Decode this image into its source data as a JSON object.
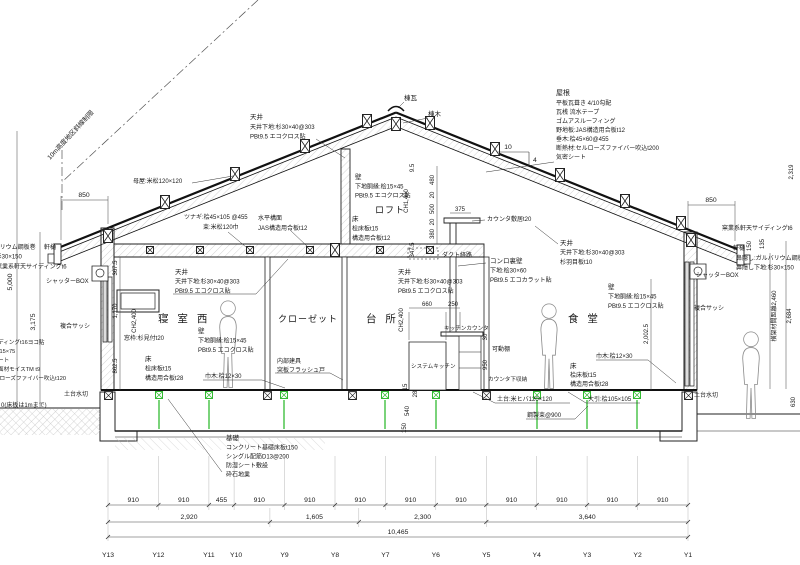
{
  "drawing_title_note": "木造住宅 矩計図(断面詳細図)",
  "labels": {
    "height_limit": "10m高度地区斜線制限",
    "purlin": "母屋:米松120×120",
    "ridge_tile": "棟瓦",
    "ridge_beam": "棟木",
    "slope_run": "10",
    "slope_rise": "4",
    "tie": "ツナギ:桧45×105 @455",
    "loft_post": "束:米松120巾",
    "counter_sill": "カウンタ敷居t20",
    "duct": "ダクト経路",
    "loft": "ロフト",
    "room_bedroom": "寝 室 西",
    "room_closet": "クローゼット",
    "room_kitchen": "台 所",
    "room_dining": "食 堂",
    "window_frame": "窓枠:杉見付t20",
    "baseboard_left": "巾木:桧12×30",
    "baseboard_right": "巾木:桧12×30",
    "kitchen_counter": "キッチンカウンタ",
    "shelves": "可動棚",
    "system_kitchen": "システムキッチン",
    "counter_storage": "カウンタ下収納",
    "soffit_left": "窯業系軒天サイディングt6",
    "soffit_right": "窯業系軒天サイディングt6",
    "gutter_left": "軒樋",
    "gutter_right": "軒樋",
    "fascia_left": "鼻隠し:ガルバリウム鋼板巻",
    "fascia_base_left": "鼻隠し下地:杉30×150",
    "fascia_right": "鼻隠し:ガルバリウム鋼板巻",
    "fascia_base_right": "鼻隠し下地:杉30×150",
    "shutter_left": "シャッターBOX",
    "shutter_right": "シャッターBOX",
    "sash_left": "複合サッシ",
    "sash_right": "複合サッシ",
    "gl_note": "0(床板は1mまで)",
    "water_drip_left": "土台水切",
    "water_drip_right": "土台水切",
    "sill_beam": "土台:米ヒバ120×120",
    "floor_joist": "大引:桧105×105",
    "steel_post": "鋼製束@900"
  },
  "blocks": {
    "roof": [
      "屋根",
      "平板瓦葺き 4/10勾配",
      "瓦桟 流水テープ",
      "ゴムアスルーフィング",
      "野地板:JAS構造用合板t12",
      "垂木:桧45×60@455",
      "断熱材:セルローズファイバー吹込t200",
      "気密シート"
    ],
    "ceiling_ridge": [
      "天井",
      "天井下地:杉30×40@303",
      "PBt9.5 エコクロス貼"
    ],
    "ceiling_west": [
      "天井",
      "天井下地:杉30×40@303",
      "PBt9.5 エコクロス貼"
    ],
    "ceiling_kitchen": [
      "天井",
      "天井下地:杉30×40@303",
      "PBt9.5 エコクロス貼"
    ],
    "ceiling_dining": [
      "天井",
      "天井下地:杉30×40@303",
      "杉羽目板t10"
    ],
    "horizontal_plane": [
      "水平構面",
      "JAS構造用合板t12"
    ],
    "loft_wall": [
      "壁",
      "下地胴縁:桧15×45",
      "PBt9.5 エコクロス貼"
    ],
    "loft_floor": [
      "床",
      "桧床板t15",
      "構造用合板t12"
    ],
    "stove_wall": [
      "コンロ裏壁",
      "下地:桧30×60",
      "PBt9.5 エコカラット貼"
    ],
    "wall_west": [
      "壁",
      "下地胴縁:桧15×45",
      "PBt9.5 エコクロス貼"
    ],
    "wall_dining": [
      "壁",
      "下地胴縁:桧15×45",
      "PBt9.5 エコクロス貼"
    ],
    "interior_door": [
      "内部建具",
      "突板フラッシュ戸"
    ],
    "floor_west": [
      "床",
      "桧床板t15",
      "構造用合板t28"
    ],
    "floor_dining": [
      "床",
      "桧床板t15",
      "構造用合板t28"
    ],
    "siding": [
      "窯業系サイディングt16ヨコ貼",
      "通気胴縁:桧15×75",
      "透湿防水シート",
      "構造用耐力面材モイスTM t9",
      "断熱材:セルローズファイバー吹込t120"
    ],
    "foundation": [
      "基礎",
      "コンクリート基礎床板t150",
      "シングル配筋D13@200",
      "防湿シート敷設",
      "砕石地業"
    ]
  },
  "dims": {
    "left_850": "850",
    "right_850": "850",
    "v5000": "5,000",
    "v3175": "3,175",
    "v2319": "2,319",
    "v150": "150",
    "v135": "135",
    "beam_span": "横架材間距離2,460",
    "v2684": "2,684",
    "v630": "630",
    "v20025": "2,002.5",
    "w367": "367.5",
    "w1170": "1,170",
    "w862": "862.5",
    "ch2400_west": "CH2,400",
    "ch2400_kitchen": "CH2,400",
    "ch1400": "CH1,400",
    "l95": "9.5",
    "l480": "480",
    "l20a": "20",
    "l500": "500",
    "l20b": "20",
    "l380": "380",
    "l375": "375",
    "l3475": "347.5",
    "k660": "660",
    "k250": "250",
    "k30": "30",
    "k950": "950",
    "f15": "15",
    "f28": "28",
    "f540": "540",
    "f150": "150",
    "bottom_segments": [
      "910",
      "910",
      "455",
      "910",
      "910",
      "910",
      "910",
      "910",
      "910",
      "910",
      "910",
      "910"
    ],
    "bottom_groups": [
      "2,920",
      "1,605",
      "2,300",
      "3,640"
    ],
    "bottom_total": "10,465",
    "grid_labels": [
      "Y13",
      "Y12",
      "Y11",
      "Y10",
      "Y9",
      "Y8",
      "Y7",
      "Y6",
      "Y5",
      "Y4",
      "Y3",
      "Y2",
      "Y1"
    ]
  },
  "colors": {
    "line": "#1a1a1a",
    "hatch": "#aaaaaa",
    "post_green": "#33bb33"
  }
}
